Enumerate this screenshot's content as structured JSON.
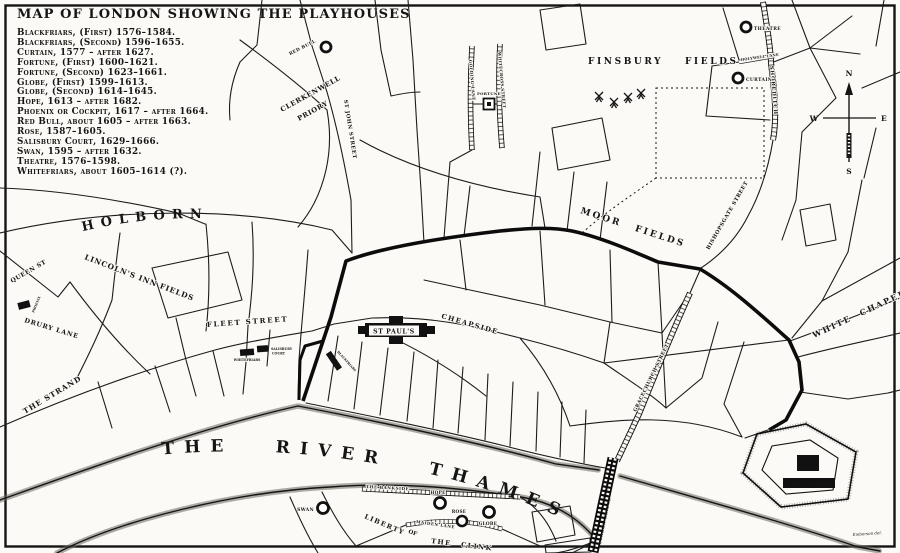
{
  "title": "MAP OF LONDON SHOWING THE PLAYHOUSES",
  "legend": {
    "items": [
      "Blackfriars, (First) 1576–1584.",
      "Blackfriars, (Second) 1596–1655.",
      "Curtain, 1577 – after 1627.",
      "Fortune, (First) 1600–1621.",
      "Fortune, (Second) 1623–1661.",
      "Globe, (First) 1599–1613.",
      "Globe, (Second) 1614–1645.",
      "Hope, 1613 – after 1682.",
      "Phoenix or Cockpit, 1617 – after 1664.",
      "Red Bull, about 1605 – after 1663.",
      "Rose, 1587–1605.",
      "Salisbury Court, 1629–1666.",
      "Swan, 1595 – after 1632.",
      "Theatre, 1576–1598.",
      "Whitefriars, about 1605–1614 (?)."
    ]
  },
  "map": {
    "areas": {
      "finsbury_fields": "FINSBURY FIELDS",
      "moor_fields": "MOOR FIELDS",
      "lincolns_inn_fields": "LINCOLN'S INN FIELDS",
      "clerkenwell_1": "CLERKENWELL",
      "clerkenwell_2": "PRIORY",
      "liberty_1": "LIBERTY",
      "liberty_2": "OF",
      "liberty_3": "THE CLINK",
      "the_tower": "THE TOWER"
    },
    "streets": {
      "holborn": "HOLBORN",
      "queen_st": "QUEEN ST",
      "drury_lane": "DRURY LANE",
      "the_strand": "THE STRAND",
      "fleet_street": "FLEET STREET",
      "cheapside": "CHEAPSIDE",
      "st_john_street": "ST JOHN STREET",
      "golding_lane": "GOLDING LANE",
      "whitecross_street": "WHITECROSS STREET",
      "shoreditch": "SHOREDITCH",
      "holywell_lane": "HOLYWELL LANE",
      "bishopsgate_street": "BISHOPSGATE STREET",
      "gracechurch_street": "GRACECHURCH STREET",
      "white_chapel": "WHITE CHAPEL",
      "the_bankside": "THE BANKSIDE",
      "maiden_lane": "MAIDEN LANE",
      "london_bridge": "LONDON BRIDGE"
    },
    "river": {
      "label": "THE RIVER THAMES"
    },
    "landmarks": {
      "st_pauls": "ST PAUL'S"
    },
    "playhouses": [
      {
        "label": "THEATRE"
      },
      {
        "label": "CURTAIN"
      },
      {
        "label": "RED BULL"
      },
      {
        "label": "FORTUNE"
      },
      {
        "label": "PHOENIX"
      },
      {
        "label": "WHITEFRIARS"
      },
      {
        "label": "SALISBURY",
        "label2": "COURT"
      },
      {
        "label": "BLACKFRIARS"
      },
      {
        "label": "SWAN"
      },
      {
        "label": "HOPE"
      },
      {
        "label": "ROSE"
      },
      {
        "label": "GLOBE"
      }
    ],
    "compass": {
      "n": "N",
      "e": "E",
      "s": "S",
      "w": "W"
    },
    "signature": "Emberson del."
  }
}
